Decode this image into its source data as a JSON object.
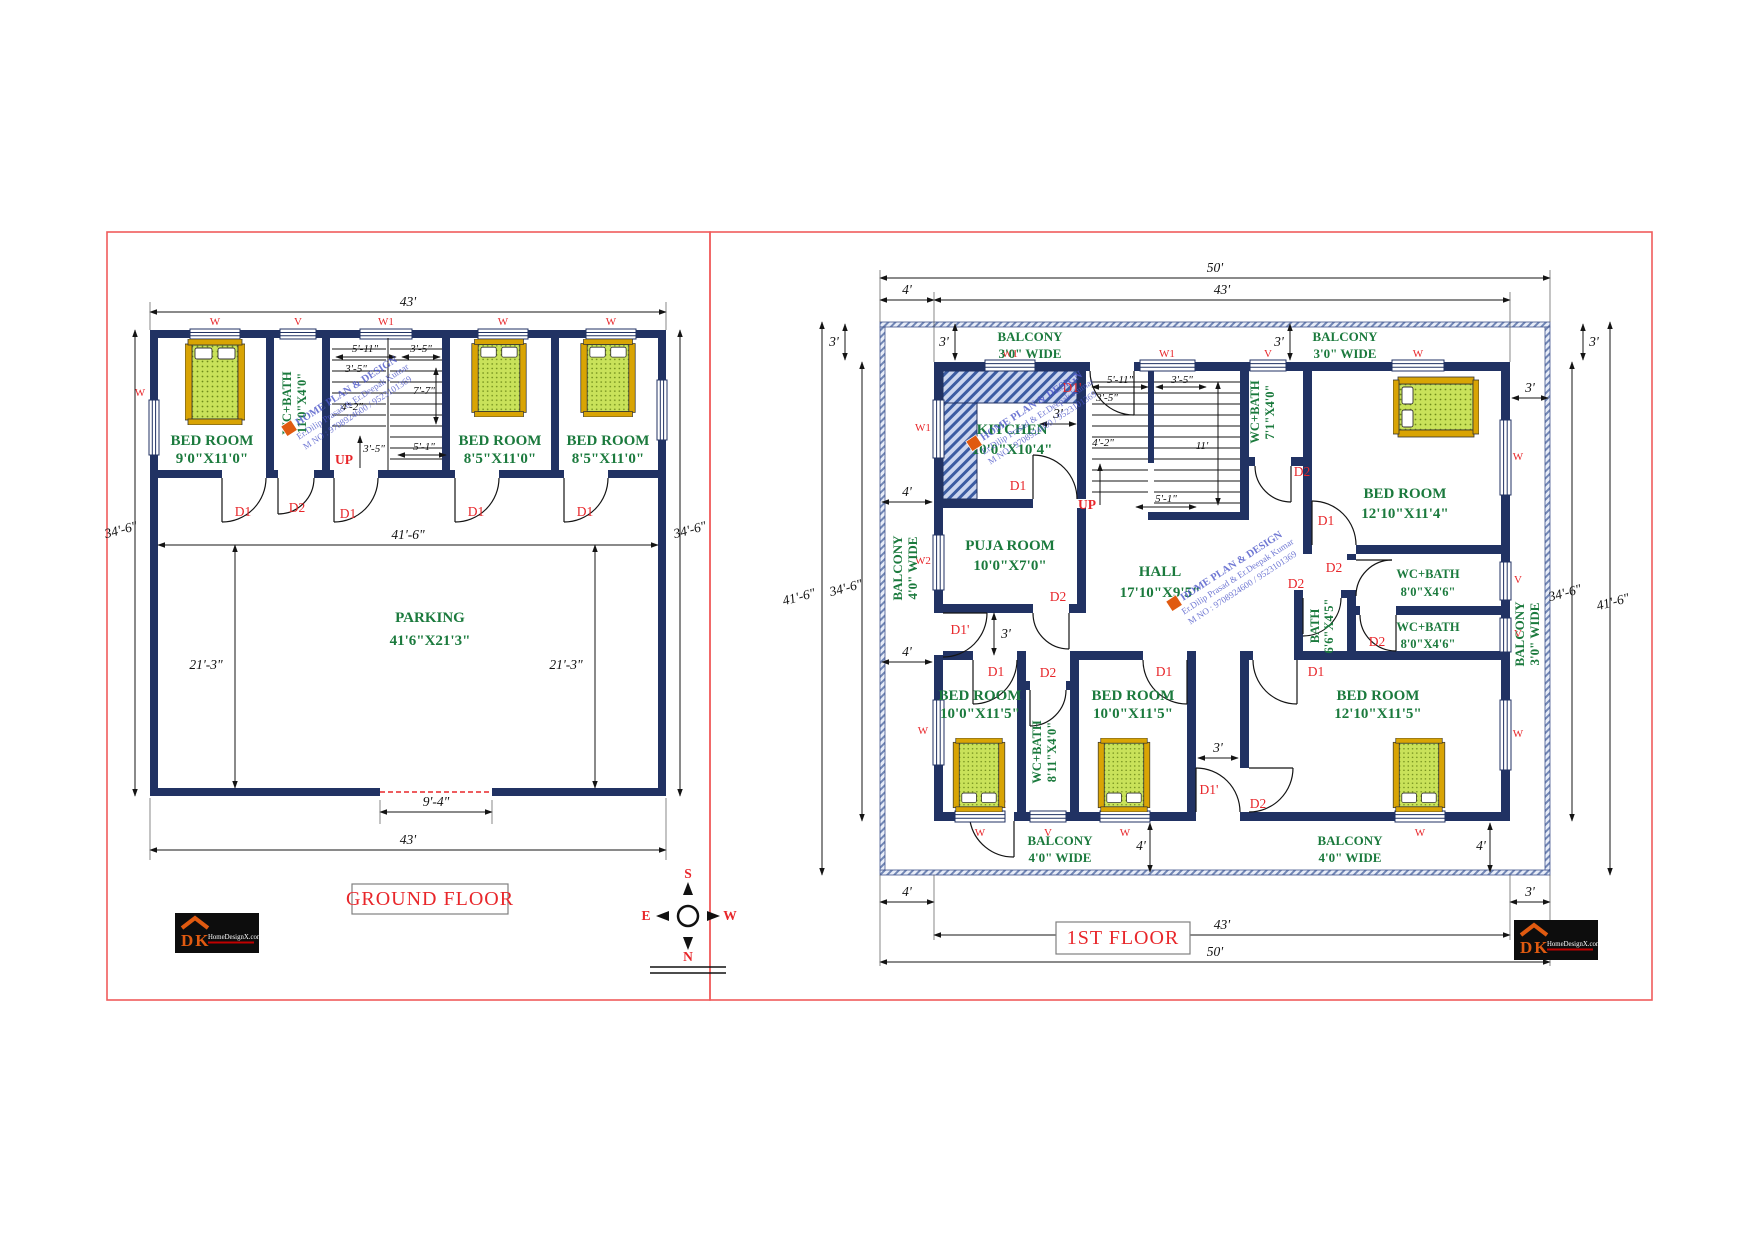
{
  "panels": {
    "ground_title": "GROUND FLOOR",
    "first_title": "1ST FLOOR"
  },
  "rooms": {
    "bed_9x11": {
      "name": "BED ROOM",
      "size": "9'0\"X11'0\""
    },
    "bed_85x11": {
      "name": "BED ROOM",
      "size": "8'5\"X11'0\""
    },
    "wc_11x4": {
      "name": "WC+BATH",
      "size": "11'0\"X4'0\""
    },
    "parking": {
      "name": "PARKING",
      "size": "41'6\"X21'3\""
    },
    "kitchen": {
      "name": "KITCHEN",
      "size": "10'0\"X10'4\""
    },
    "puja": {
      "name": "PUJA ROOM",
      "size": "10'0\"X7'0\""
    },
    "hall": {
      "name": "HALL",
      "size": "17'10\"X9'5\""
    },
    "wc_71x4": {
      "name": "WC+BATH",
      "size": "7'1\"X4'0\""
    },
    "wc_8x46": {
      "name": "WC+BATH",
      "size": "8'0\"X4'6\""
    },
    "bath_66x45": {
      "name": "BATH",
      "size": "6'6\"X4'5\""
    },
    "wc_811x4": {
      "name": "WC+BATH",
      "size": "8'11\"X4'0\""
    },
    "bed_1210x114": {
      "name": "BED ROOM",
      "size": "12'10\"X11'4\""
    },
    "bed_10x115": {
      "name": "BED ROOM",
      "size": "10'0\"X11'5\""
    },
    "bed_1210x115": {
      "name": "BED ROOM",
      "size": "12'10\"X11'5\""
    },
    "balcony3": {
      "name": "BALCONY",
      "size": "3'0\" WIDE"
    },
    "balcony4": {
      "name": "BALCONY",
      "size": "4'0\" WIDE"
    }
  },
  "dims": {
    "ft43": "43'",
    "ft50": "50'",
    "ft34_6": "34'-6\"",
    "ft41_6": "41'-6\"",
    "ft21_3": "21'-3\"",
    "ft9_4": "9'-4\"",
    "ft3": "3'",
    "ft4": "4'",
    "ft11": "11'",
    "ft5_11": "5'-11\"",
    "ft3_5": "3'-5\"",
    "ft7_7": "7'-7\"",
    "ft4_2": "4'-2\"",
    "ft5_1": "5'-1\""
  },
  "marks": {
    "d1": "D1",
    "d1p": "D1'",
    "d2": "D2",
    "up": "UP",
    "w": "W",
    "w1": "W1",
    "w2": "W2",
    "v": "V"
  },
  "compass": {
    "n": "N",
    "s": "S",
    "e": "E",
    "w": "W"
  },
  "watermark": {
    "line1": "HOME PLAN & DESIGN",
    "line2": "Er.Dilip Prasad & Er.Deepak Kumar",
    "line3": "M NO : 9708924600 / 9523101369"
  },
  "logo": {
    "short": "DK",
    "site": "HomeDesignX.com"
  },
  "colors": {
    "wall": "#213263",
    "label_green": "#1b7a3d",
    "label_red": "#e8262a",
    "bed_rail": "#d9a404",
    "bed_mattress": "#c9e25a",
    "panel_border": "#f05c5c"
  }
}
